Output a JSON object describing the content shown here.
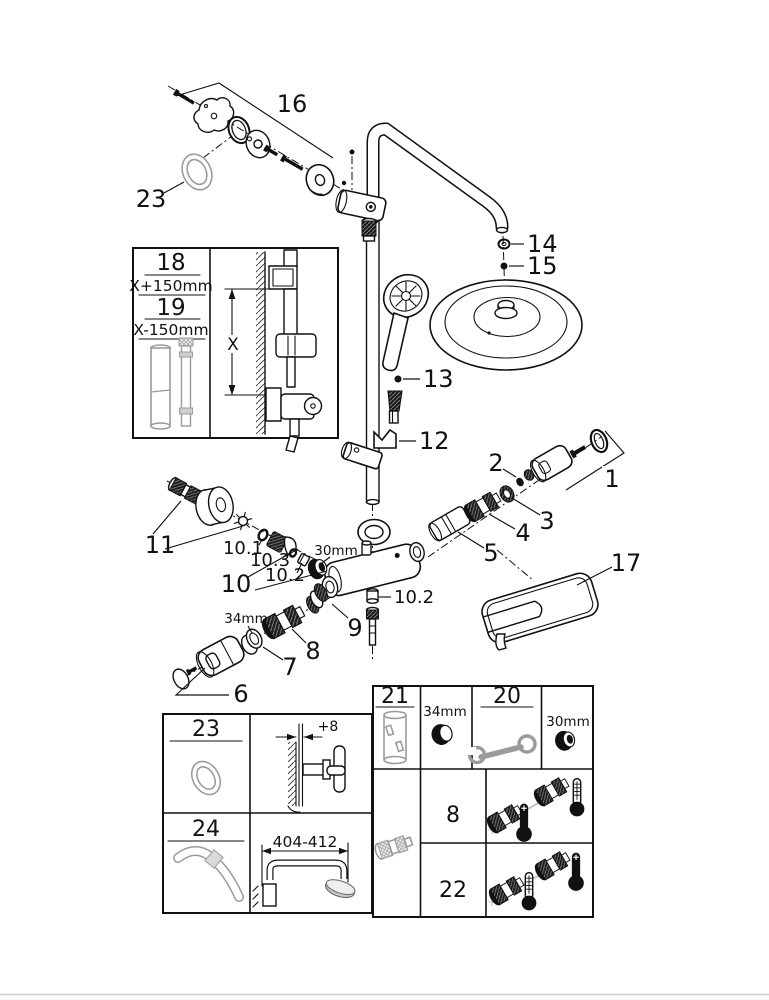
{
  "colors": {
    "line": "#111111",
    "gray_part": "#9b9b9b",
    "page_edge": "#cfcfcf",
    "background": "#ffffff"
  },
  "callouts": {
    "p1": "1",
    "p2": "2",
    "p3": "3",
    "p4": "4",
    "p5": "5",
    "p6": "6",
    "p7": "7",
    "p8": "8",
    "p9": "9",
    "p10": "10",
    "p10_1": "10.1",
    "p10_2": "10.2",
    "p10_2b": "10.2",
    "p10_3": "10.3",
    "p11": "11",
    "p12": "12",
    "p13": "13",
    "p14": "14",
    "p15": "15",
    "p16": "16",
    "p17": "17",
    "p23": "23",
    "dim_30mm": "30mm",
    "dim_34mm": "34mm"
  },
  "inset_box": {
    "p18": "18",
    "p18_dim": "X+150mm",
    "p19": "19",
    "p19_dim": "X-150mm",
    "x_label": "X"
  },
  "bottom_left_table": {
    "cell_23": "23",
    "cell_23_dim": "+8",
    "cell_24": "24",
    "cell_24_dim": "404-412"
  },
  "bottom_right_table": {
    "cell_21": "21",
    "cell_21_dim": "34mm",
    "cell_20": "20",
    "cell_20_dim": "30mm",
    "row_8": "8",
    "row_22": "22"
  }
}
